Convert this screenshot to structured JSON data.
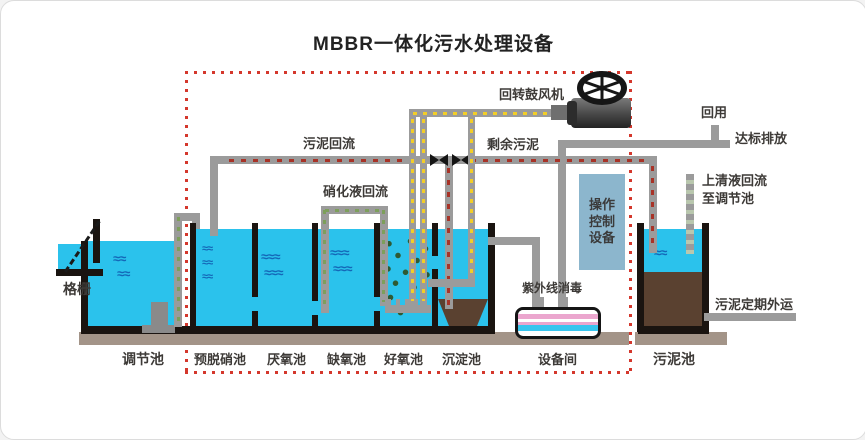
{
  "title": "MBBR一体化污水处理设备",
  "tanks": {
    "labels": [
      "调节池",
      "预脱硝池",
      "厌氧池",
      "缺氧池",
      "好氧池",
      "沉淀池",
      "设备间",
      "污泥池"
    ]
  },
  "flows": {
    "screen": "格栅",
    "sludge_return": "污泥回流",
    "nitrified_return": "硝化液回流",
    "blower": "回转鼓风机",
    "excess_sludge": "剩余污泥",
    "reuse": "回用",
    "discharge": "达标排放",
    "supernatant_line1": "上清液回流",
    "supernatant_line2": "至调节池",
    "uv": "紫外线消毒",
    "sludge_out": "污泥定期外运"
  },
  "control_cabinet": {
    "lines": [
      "操作",
      "控制",
      "设备"
    ]
  },
  "colors": {
    "water": "#2bc2ec",
    "wave": "#1468b8",
    "sludge_brown": "#5a4130",
    "pipe_gray": "#9b9b9b",
    "boundary_red": "#d4372c",
    "air_yellow": "#f2cd28",
    "flow_red": "#a83327",
    "recycle_green": "#7d9f5b",
    "control_box_blue": "#8cb6cd",
    "uv_pink": "#eba6ce",
    "base_gray": "#a39488"
  }
}
